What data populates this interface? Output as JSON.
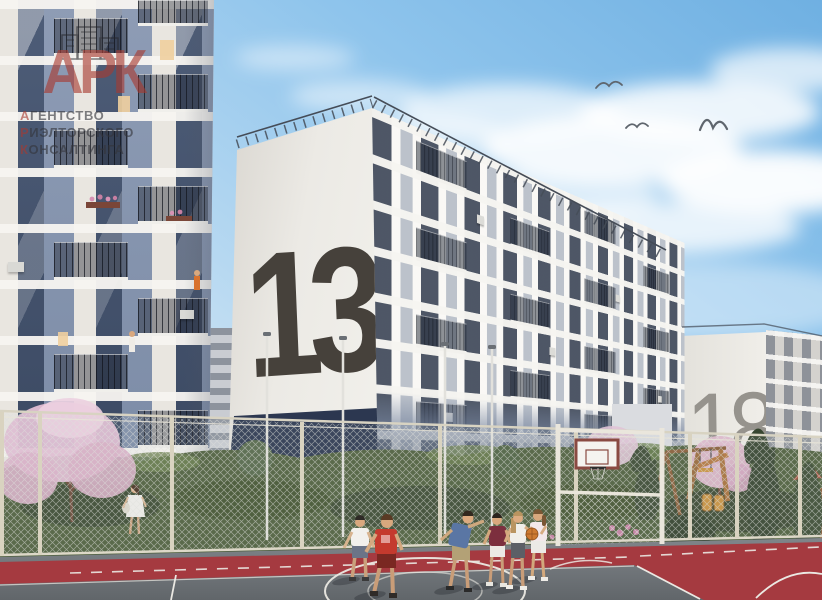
{
  "scene": {
    "type": "3D architectural rendering of a residential complex",
    "subject": "Courtyard sports court with children playing basketball between new apartment buildings",
    "sky": "blue spring sky with white clouds",
    "birds_count": "3"
  },
  "watermark": {
    "logo": "АРК",
    "line1_first": "А",
    "line1_rest": "ГЕНТСТВО",
    "line2_first": "Р",
    "line2_rest": "ИЭЛТОРСКОГО",
    "line3_first": "К",
    "line3_rest": "ОНСАЛТИНГА",
    "accent_color": "#a83a30",
    "text_color": "#34353b"
  },
  "buildings": {
    "center": {
      "number": "13",
      "number_color": "#46413b",
      "wall_color": "#eceae5",
      "base_color": "#2c3750"
    },
    "right": {
      "number": "18",
      "number_color": "#96938d",
      "wall_color": "#edebe6"
    },
    "left": {
      "description": "white tower with blue-gray panels, glazed balconies, residents and flower boxes on balconies"
    }
  },
  "foreground": {
    "court": {
      "surface_color": "#73787b",
      "border_color": "#a53a40",
      "line_color": "#ebe9e3"
    },
    "players": [
      "boy in white t-shirt",
      "boy in red t-shirt",
      "boy in blue t-shirt",
      "boy in maroon jersey",
      "girl in white top and dark leggings",
      "girl in white holding orange basketball"
    ],
    "pedestrian": "woman in white dress walking on path behind fence",
    "equipment": "combined basketball backboard and goal frame inside chain-link fence",
    "playground": "wooden play structures among conifers",
    "vegetation": "pink blossoming trees, shrubs, dark conifers"
  }
}
